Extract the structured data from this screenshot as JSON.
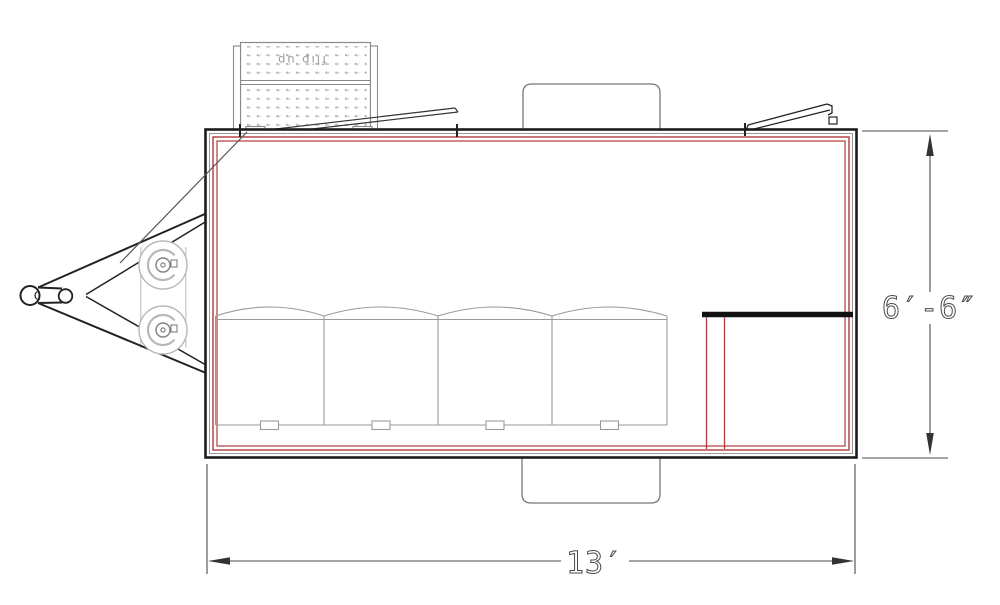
{
  "dimensions": {
    "length": {
      "label": "13′",
      "feet": 13
    },
    "height": {
      "label": "6′-6″",
      "feet": 6.5
    }
  },
  "annotations": {
    "pegboard_note": "flip up"
  },
  "colors": {
    "wall_outline": "#1c1c1c",
    "wall_liner_red": "#b03a3a",
    "equipment_gray": "#9a9a9a",
    "dimension_gray": "#4a4a4a"
  }
}
